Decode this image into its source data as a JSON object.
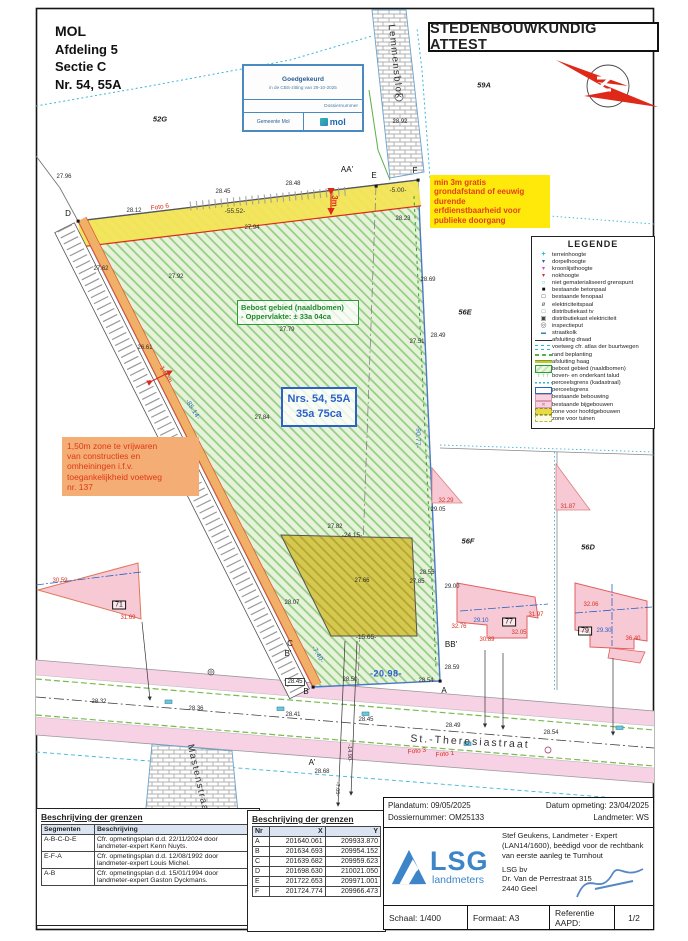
{
  "header": {
    "municipality": "MOL",
    "afdeling": "Afdeling 5",
    "sectie": "Sectie C",
    "nummer": "Nr. 54, 55A"
  },
  "title": {
    "text": "STEDENBOUWKUNDIG ATTEST"
  },
  "stamp": {
    "line1": "Goedgekeurd",
    "line2": "in de CBS-zitting van 29-10-2025",
    "line3": "Dossiernummer",
    "line4": "Gemeente Mol",
    "logo": "mol"
  },
  "notes": {
    "yellow": "min 3m gratis\ngrondafstand of eeuwig\ndurende\nerfdienstbaarheid voor\npublieke doorgang",
    "orange": "1,50m zone te vrijwaren\nvan constructies en\nomheiningen i.f.v.\ntoegankelijkheid voetweg\nnr. 137"
  },
  "boxes": {
    "bebost_line1": "Bebost gebied (naaldbomen)",
    "bebost_line2": "- Oppervlakte: ± 33a 04ca",
    "nrs_line1": "Nrs. 54, 55A",
    "nrs_line2": "35a 75ca"
  },
  "legend": {
    "title": "LEGENDE",
    "items": [
      {
        "sym": "plus-cyan",
        "label": "terreinhoogte"
      },
      {
        "sym": "tri-blue",
        "label": "dorpelhoogte"
      },
      {
        "sym": "tri-magenta",
        "label": "kroonlijsthoogte"
      },
      {
        "sym": "tri-red",
        "label": "nokhoogte"
      },
      {
        "sym": "circ-cyan",
        "label": "niet gematerialiseerd grenspunt"
      },
      {
        "sym": "sq-black",
        "label": "bestaande betonpaal"
      },
      {
        "sym": "sq-open",
        "label": "bestaande fenopaal"
      },
      {
        "sym": "pole",
        "label": "elektriciteitspaal"
      },
      {
        "sym": "sq-green",
        "label": "distributiekast tv"
      },
      {
        "sym": "sq-dark",
        "label": "distributiekast elektriciteit"
      },
      {
        "sym": "inspect",
        "label": "inspectieput"
      },
      {
        "sym": "kolk",
        "label": "straatkolk"
      },
      {
        "sym": "line-draad",
        "label": "afsluiting draad"
      },
      {
        "sym": "line-voetweg",
        "label": "voetweg cfr. atlas der buurtwegen"
      },
      {
        "sym": "line-beplanting",
        "label": "rand beplanting"
      },
      {
        "sym": "line-haag",
        "label": "afsluiting haag"
      },
      {
        "sym": "rect-bebost",
        "label": "bebost gebied (naaldbomen)"
      },
      {
        "sym": "talud",
        "label": "boven- en onderkant talud"
      },
      {
        "sym": "line-kadaster",
        "label": "perceelsgrens (kadastraal)"
      },
      {
        "sym": "rect-perceel",
        "label": "perceelsgrens"
      },
      {
        "sym": "rect-bebouwing",
        "label": "bestaande bebouwing"
      },
      {
        "sym": "rect-bijgebouw",
        "label": "bestaande bijgebouwen"
      },
      {
        "sym": "rect-hoofdgebouw",
        "label": "zone voor hoofdgebouwen"
      },
      {
        "sym": "rect-tuin",
        "label": "zone voor tuinen"
      }
    ]
  },
  "tables": {
    "segments": {
      "title": "Beschrijving der grenzen",
      "headers": [
        "Segmenten",
        "Beschrijving"
      ],
      "rows": [
        [
          "A-B-C-D-E",
          "Cfr. opmetingsplan d.d. 22/11/2024 door landmeter-expert Kenn Nuyts."
        ],
        [
          "E-F-A",
          "Cfr. opmetingsplan d.d. 12/08/1992 door landmeter-expert Louis Michel."
        ],
        [
          "A-B",
          "Cfr. opmetingsplan d.d. 15/01/1994 door landmeter-expert Gaston Dyckmans."
        ]
      ]
    },
    "coords": {
      "title": "Beschrijving der grenzen",
      "headers": [
        "Nr",
        "X",
        "Y"
      ],
      "rows": [
        [
          "A",
          "201640.061",
          "209933.870"
        ],
        [
          "B",
          "201634.693",
          "209954.152"
        ],
        [
          "C",
          "201639.682",
          "209959.623"
        ],
        [
          "D",
          "201698.630",
          "210021.050"
        ],
        [
          "E",
          "201722.653",
          "209971.001"
        ],
        [
          "F",
          "201724.774",
          "209966.473"
        ]
      ]
    }
  },
  "titleblock": {
    "plandatum": "Plandatum: 09/05/2025",
    "dossiernummer": "Dossiernummer: OM25133",
    "datum_opmeting": "Datum opmeting: 23/04/2025",
    "landmeter": "Landmeter: WS",
    "logo_text": "LSG",
    "logo_sub": "landmeters",
    "expert_line1": "Stef Geukens, Landmeter - Expert",
    "expert_line2": "(LAN14/1600), beëdigd voor de rechtbank",
    "expert_line3": "van eerste aanleg te Turnhout",
    "firm": "LSG bv",
    "address": "Dr. Van de Perrestraat 315",
    "city": "2440 Geel",
    "schaal": "Schaal: 1/400",
    "formaat": "Formaat: A3",
    "referentie": "Referentie AAPD:",
    "page": "1/2"
  },
  "map": {
    "labels": [
      {
        "t": "52G",
        "x": 160,
        "y": 119,
        "c": "pk"
      },
      {
        "t": "59A",
        "x": 484,
        "y": 85,
        "c": "pk"
      },
      {
        "t": "56E",
        "x": 465,
        "y": 312,
        "c": "pk"
      },
      {
        "t": "56F",
        "x": 468,
        "y": 541,
        "c": "pk"
      },
      {
        "t": "56D",
        "x": 588,
        "y": 547,
        "c": "pk"
      },
      {
        "t": "Lemmensblok",
        "x": 395,
        "y": 62,
        "c": "street",
        "r": 84
      },
      {
        "t": "Mastenstraat",
        "x": 198,
        "y": 780,
        "c": "street",
        "r": 77
      },
      {
        "t": "St.-Theresiastraat",
        "x": 470,
        "y": 742,
        "c": "streeth",
        "r": 3
      },
      {
        "t": "D",
        "x": 68,
        "y": 214,
        "c": "pt"
      },
      {
        "t": "E",
        "x": 374,
        "y": 176,
        "c": "pt"
      },
      {
        "t": "F",
        "x": 415,
        "y": 171,
        "c": "pt"
      },
      {
        "t": "AA'",
        "x": 347,
        "y": 170,
        "c": "pt"
      },
      {
        "t": "A",
        "x": 444,
        "y": 691,
        "c": "pt"
      },
      {
        "t": "B",
        "x": 306,
        "y": 692,
        "c": "pt"
      },
      {
        "t": "C",
        "x": 290,
        "y": 644,
        "c": "pt"
      },
      {
        "t": "B'",
        "x": 288,
        "y": 654,
        "c": "pt"
      },
      {
        "t": "BB'",
        "x": 451,
        "y": 645,
        "c": "pt"
      },
      {
        "t": "A'",
        "x": 312,
        "y": 763,
        "c": "pt"
      },
      {
        "t": "-55.52-",
        "x": 235,
        "y": 212,
        "c": "dimk"
      },
      {
        "t": "-5.00-",
        "x": 398,
        "y": 191,
        "c": "dimk"
      },
      {
        "t": "3m",
        "x": 334,
        "y": 201,
        "c": "red3m",
        "r": 90
      },
      {
        "t": "-85.14-",
        "x": 192,
        "y": 410,
        "c": "dim",
        "r": 58
      },
      {
        "t": "1.50m",
        "x": 165,
        "y": 375,
        "c": "redsm",
        "r": 58
      },
      {
        "t": "-90.77-",
        "x": 417,
        "y": 437,
        "c": "dim",
        "r": 92
      },
      {
        "t": "-7.40-",
        "x": 317,
        "y": 655,
        "c": "dim",
        "r": 60
      },
      {
        "t": "-20.98-",
        "x": 386,
        "y": 674,
        "c": "dimb"
      },
      {
        "t": "-24.15-",
        "x": 352,
        "y": 536,
        "c": "dimk"
      },
      {
        "t": "-15.65-",
        "x": 366,
        "y": 638,
        "c": "dimk"
      },
      {
        "t": "-14.90-",
        "x": 348,
        "y": 753,
        "c": "dimks",
        "r": 90
      },
      {
        "t": "-7.05-",
        "x": 336,
        "y": 789,
        "c": "dimks",
        "r": 90
      },
      {
        "t": "27.96",
        "x": 64,
        "y": 177,
        "c": "el"
      },
      {
        "t": "28.12",
        "x": 134,
        "y": 211,
        "c": "el"
      },
      {
        "t": "28.45",
        "x": 223,
        "y": 192,
        "c": "el"
      },
      {
        "t": "28.48",
        "x": 293,
        "y": 184,
        "c": "el"
      },
      {
        "t": "27.94",
        "x": 252,
        "y": 228,
        "c": "el"
      },
      {
        "t": "28.23",
        "x": 403,
        "y": 219,
        "c": "el"
      },
      {
        "t": "28.92",
        "x": 400,
        "y": 122,
        "c": "el"
      },
      {
        "t": "27.92",
        "x": 176,
        "y": 277,
        "c": "el"
      },
      {
        "t": "27.62",
        "x": 101,
        "y": 269,
        "c": "el"
      },
      {
        "t": "27.79",
        "x": 287,
        "y": 330,
        "c": "el"
      },
      {
        "t": "27.84",
        "x": 262,
        "y": 418,
        "c": "el"
      },
      {
        "t": "26.61",
        "x": 145,
        "y": 348,
        "c": "el"
      },
      {
        "t": "28.69",
        "x": 428,
        "y": 280,
        "c": "el"
      },
      {
        "t": "28.49",
        "x": 438,
        "y": 336,
        "c": "el"
      },
      {
        "t": "27.51",
        "x": 417,
        "y": 342,
        "c": "el"
      },
      {
        "t": "29.05",
        "x": 438,
        "y": 510,
        "c": "el"
      },
      {
        "t": "28.55",
        "x": 427,
        "y": 573,
        "c": "el"
      },
      {
        "t": "27.85",
        "x": 417,
        "y": 582,
        "c": "el"
      },
      {
        "t": "29.00",
        "x": 452,
        "y": 587,
        "c": "el"
      },
      {
        "t": "27.82",
        "x": 335,
        "y": 527,
        "c": "el"
      },
      {
        "t": "27.66",
        "x": 362,
        "y": 581,
        "c": "el"
      },
      {
        "t": "28.07",
        "x": 292,
        "y": 603,
        "c": "el"
      },
      {
        "t": "28.59",
        "x": 452,
        "y": 668,
        "c": "el"
      },
      {
        "t": "28.54",
        "x": 426,
        "y": 681,
        "c": "el"
      },
      {
        "t": "28.50",
        "x": 350,
        "y": 680,
        "c": "el"
      },
      {
        "t": "28.45",
        "x": 295,
        "y": 682,
        "c": "elbox"
      },
      {
        "t": "28.32",
        "x": 99,
        "y": 702,
        "c": "el"
      },
      {
        "t": "28.36",
        "x": 196,
        "y": 709,
        "c": "el"
      },
      {
        "t": "28.41",
        "x": 293,
        "y": 715,
        "c": "el"
      },
      {
        "t": "28.45",
        "x": 366,
        "y": 720,
        "c": "el"
      },
      {
        "t": "28.49",
        "x": 453,
        "y": 726,
        "c": "el"
      },
      {
        "t": "28.54",
        "x": 551,
        "y": 733,
        "c": "el"
      },
      {
        "t": "28.68",
        "x": 322,
        "y": 772,
        "c": "el"
      },
      {
        "t": "32.29",
        "x": 446,
        "y": 501,
        "c": "elr"
      },
      {
        "t": "31.87",
        "x": 568,
        "y": 507,
        "c": "elr"
      },
      {
        "t": "30.59",
        "x": 60,
        "y": 581,
        "c": "elr"
      },
      {
        "t": "31.69",
        "x": 128,
        "y": 618,
        "c": "elr"
      },
      {
        "t": "32.76",
        "x": 459,
        "y": 627,
        "c": "elr"
      },
      {
        "t": "30.89",
        "x": 487,
        "y": 640,
        "c": "elr"
      },
      {
        "t": "32.05",
        "x": 519,
        "y": 633,
        "c": "elr"
      },
      {
        "t": "31.97",
        "x": 536,
        "y": 615,
        "c": "elr"
      },
      {
        "t": "32.06",
        "x": 591,
        "y": 605,
        "c": "elr"
      },
      {
        "t": "36.40",
        "x": 633,
        "y": 639,
        "c": "elr"
      },
      {
        "t": "29.10",
        "x": 481,
        "y": 621,
        "c": "elb"
      },
      {
        "t": "29.30",
        "x": 604,
        "y": 631,
        "c": "elb"
      },
      {
        "t": "71",
        "x": 119,
        "y": 605,
        "c": "ptbox"
      },
      {
        "t": "77",
        "x": 509,
        "y": 622,
        "c": "ptbox"
      },
      {
        "t": "79",
        "x": 585,
        "y": 631,
        "c": "ptbox"
      },
      {
        "t": "Foto 6",
        "x": 160,
        "y": 208,
        "c": "redsm",
        "r": -8
      },
      {
        "t": "Foto 3",
        "x": 417,
        "y": 752,
        "c": "redsm",
        "r": -6
      },
      {
        "t": "Foto 1",
        "x": 445,
        "y": 755,
        "c": "redsm",
        "r": -6
      }
    ]
  }
}
